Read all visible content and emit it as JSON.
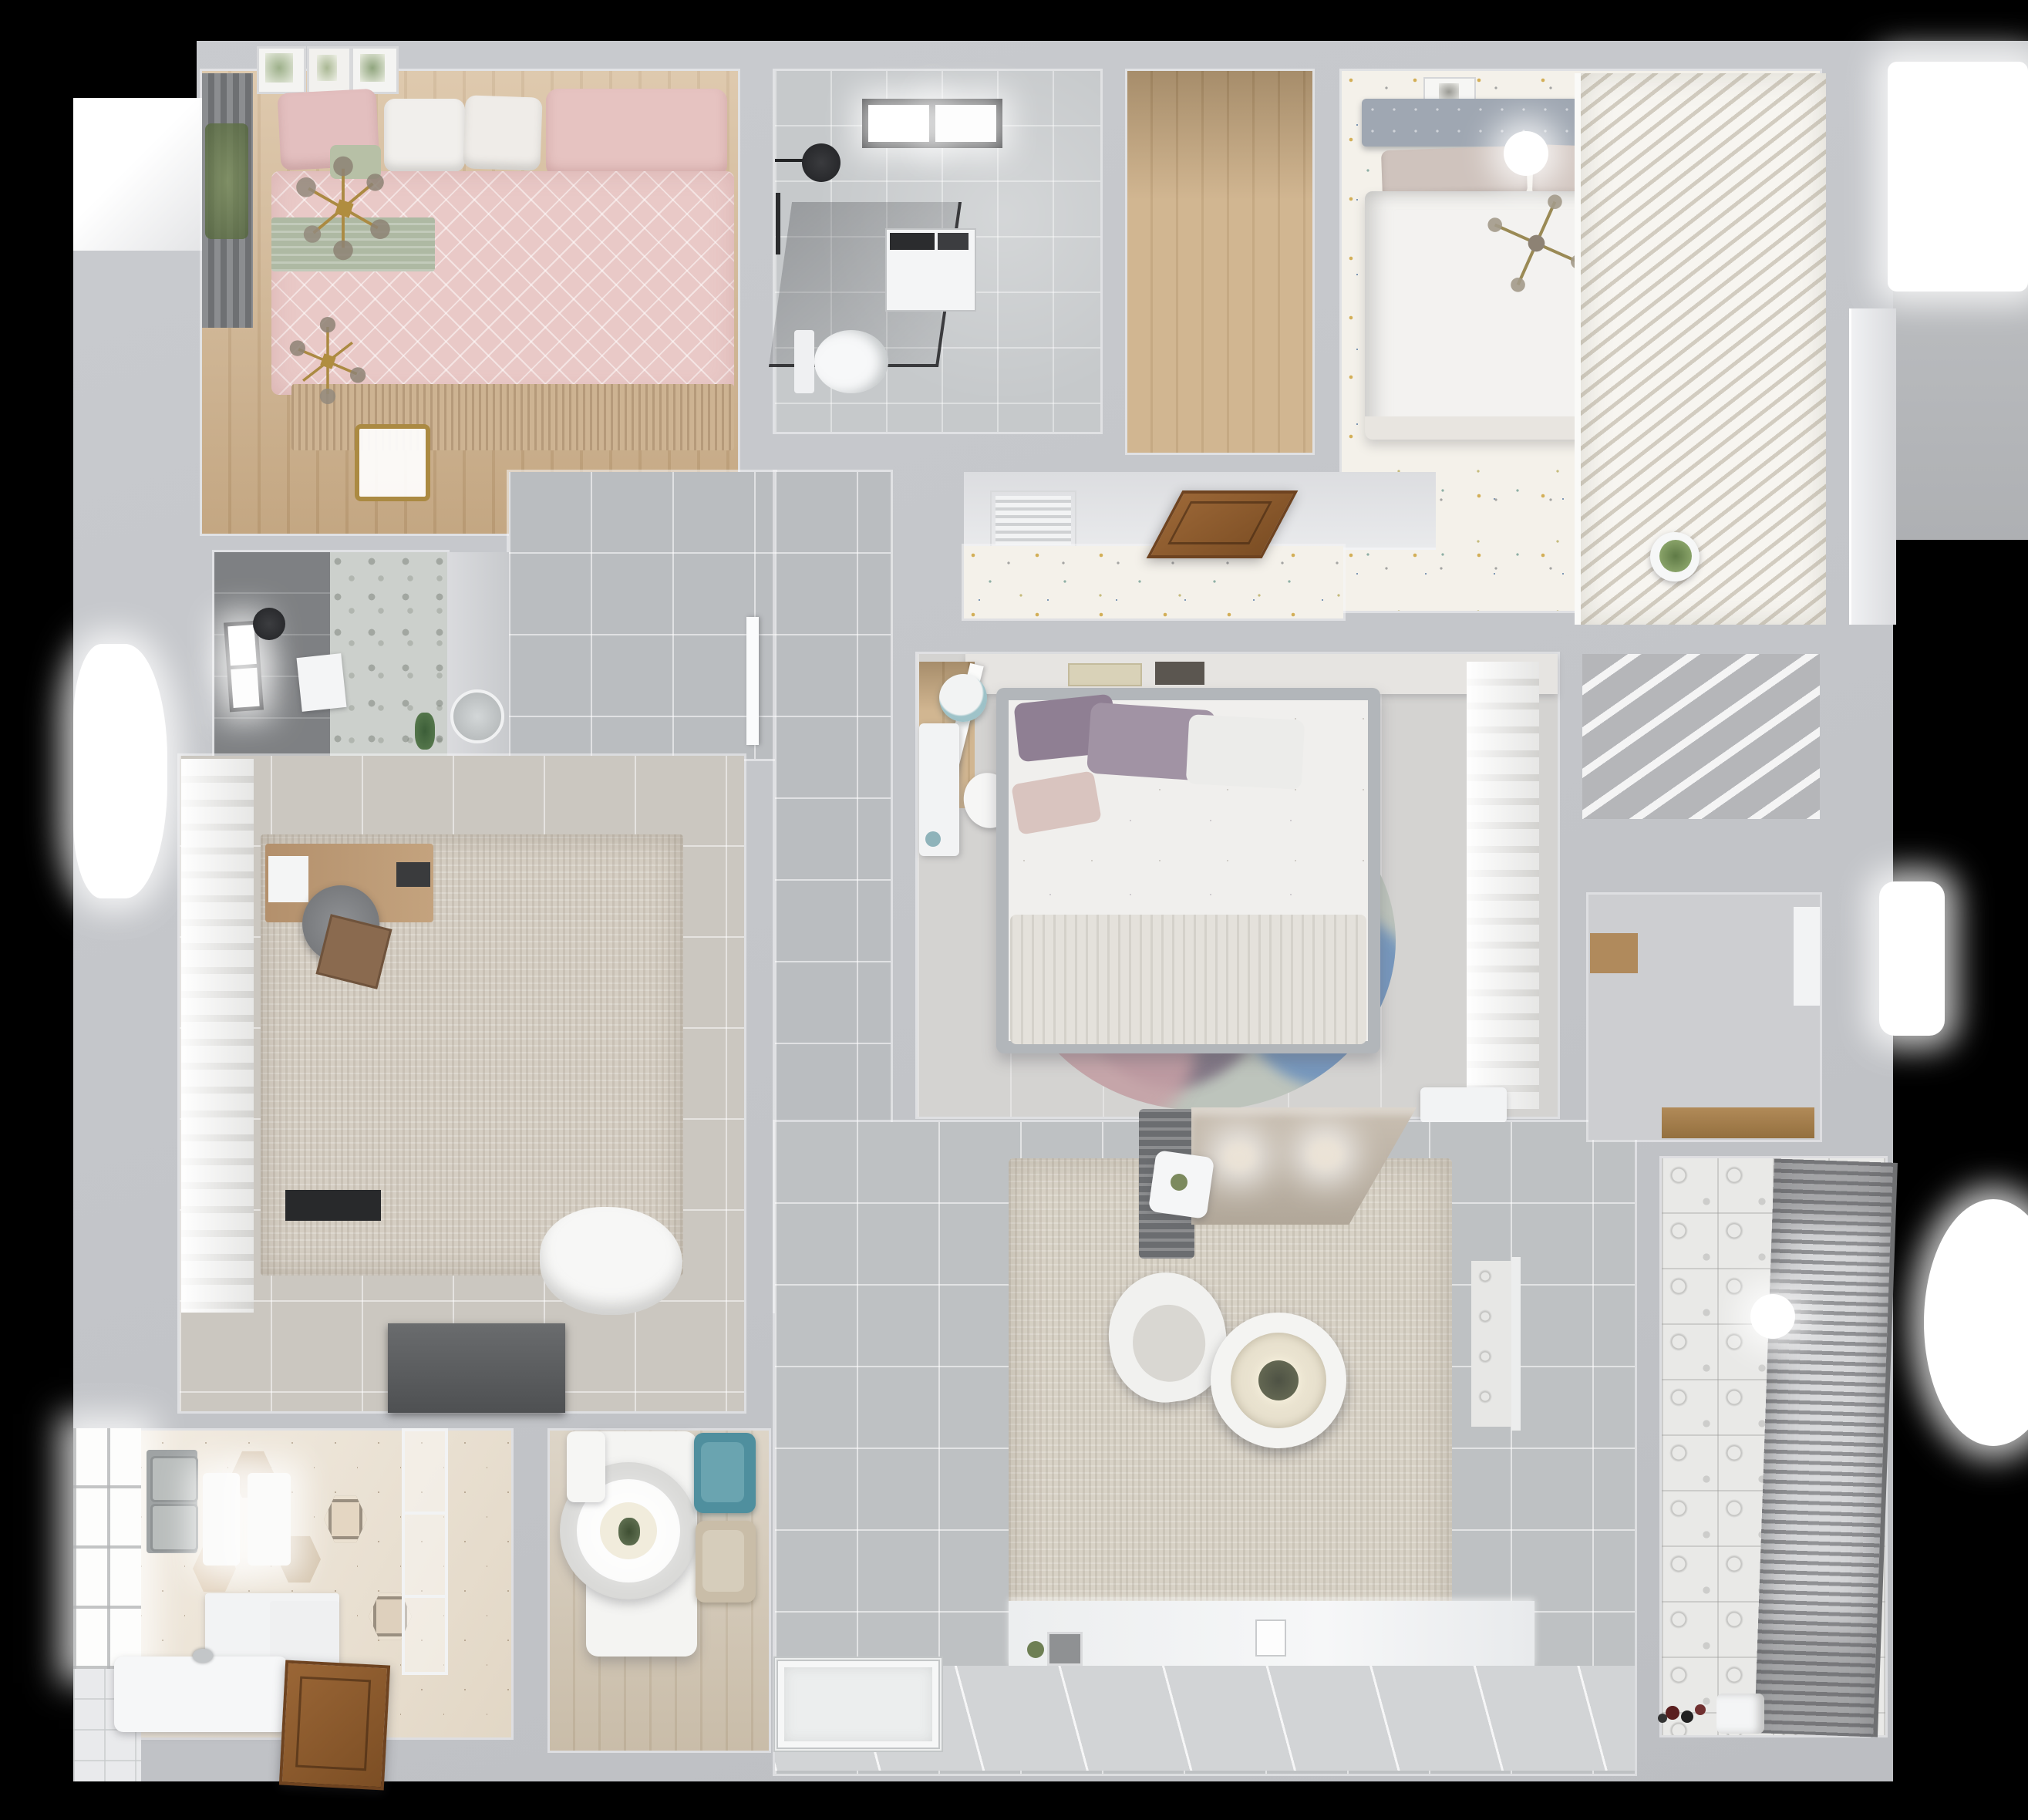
{
  "meta": {
    "title": "Apartment 3D floor plan — top-down dollhouse render",
    "view": "orthographic top-down interior render, no visible text",
    "background": "#000000"
  },
  "palette": {
    "wall": "#c9cbcf",
    "wallLight": "#e9eaed",
    "corridorTile": "#babdc0",
    "marble": "#c6c9cb",
    "confettiBase": "#f4f1ea",
    "hexTile": "#ebe1d1",
    "warmWood": "#c7a87e",
    "pinkDuvet": "#e9c9c7",
    "sageThrow": "#aeb9a3",
    "tealChair": "#4f8f9e",
    "mauvePillow": "#8f7f93",
    "blueRug": "#6f93bd",
    "rugBeige": "#d8d2c6",
    "darkTile": "#7e8083",
    "doorWood": "#8a5a2e",
    "tvBlack": "#17181a",
    "gold": "#ab8a42"
  },
  "rooms": {
    "bedroom1": {
      "name": "Bedroom 1 — pink bed, window curtains, botanical frames, gold chandeliers"
    },
    "bathroom1": {
      "name": "Bathroom 1 — skylight, black shower set, washing machine, toilet"
    },
    "closet": {
      "name": "Walk-in closet with wood plank floor"
    },
    "bedroom2": {
      "name": "Master bedroom — white bed, confetti floor, louvered wardrobe"
    },
    "entry": {
      "name": "Entry hall — open wooden front door, AC vent, plant"
    },
    "corridor": {
      "name": "Corridor — large gray floor tiles"
    },
    "bathroom2": {
      "name": "Shower room — dark tiles, window, mosaic floor, toilet"
    },
    "study": {
      "name": "Study — wardrobe curtains, wooden desk, chair, rug"
    },
    "bedroom3": {
      "name": "Bedroom 3 — gray bed, headboard shelf, desk, round color-block rug, sheer curtains"
    },
    "kitchen": {
      "name": "Kitchen — hexagon tile floor, double sink, white counters, range hood"
    },
    "dining": {
      "name": "Dining — white table, pendant plate light, teal and beige chairs"
    },
    "living": {
      "name": "Living room — beige rug, sectional sofa, ring coffee table, TV media wall"
    },
    "storage": {
      "name": "Storage room — wooden bench shelf"
    },
    "balcony": {
      "name": "Balcony — patterned cement tiles, drying rack, ball lamp, toys"
    }
  },
  "furniture": {
    "bedroom1": [
      "double-bed",
      "pink-duvet",
      "sage-throw",
      "pillows",
      "gold-chandelier",
      "gold-chandelier-foot",
      "bench-stool",
      "window-curtain",
      "art-frames"
    ],
    "bathroom1": [
      "skylight-window",
      "shower-head",
      "glass-screen",
      "washing-machine",
      "toilet"
    ],
    "bedroom2": [
      "double-bed",
      "gray-headboard",
      "ceiling-lamp",
      "gold-chandelier",
      "picture-frame",
      "louver-wardrobe",
      "potted-plant"
    ],
    "bathroom2": [
      "window",
      "shower-head",
      "towel",
      "toilet",
      "plant",
      "round-mirror"
    ],
    "study": [
      "wardrobe-curtains",
      "area-rug",
      "wood-desk",
      "desk-chair",
      "laptop",
      "storage-box",
      "white-blanket",
      "tv-panel"
    ],
    "bedroom3": [
      "headboard-shelf",
      "books",
      "double-bed",
      "purple-pillows",
      "round-rug",
      "white-desk",
      "desk-chair",
      "blue-stool",
      "sheer-curtains",
      "bench",
      "side-table"
    ],
    "kitchen": [
      "window-wall",
      "double-sink",
      "counters",
      "island",
      "range-hood",
      "glass-partition",
      "wood-door"
    ],
    "dining": [
      "white-table",
      "pendant-plate-lamp",
      "teal-chair",
      "beige-chair",
      "white-chair"
    ],
    "living": [
      "sectional-sofa",
      "gray-throw",
      "armchair",
      "ring-coffee-table",
      "area-rug",
      "media-console",
      "flat-tv",
      "ornate-mat",
      "side-table"
    ],
    "balcony": [
      "drying-rack",
      "ball-lamp",
      "toy-cars",
      "paper-bags"
    ]
  }
}
